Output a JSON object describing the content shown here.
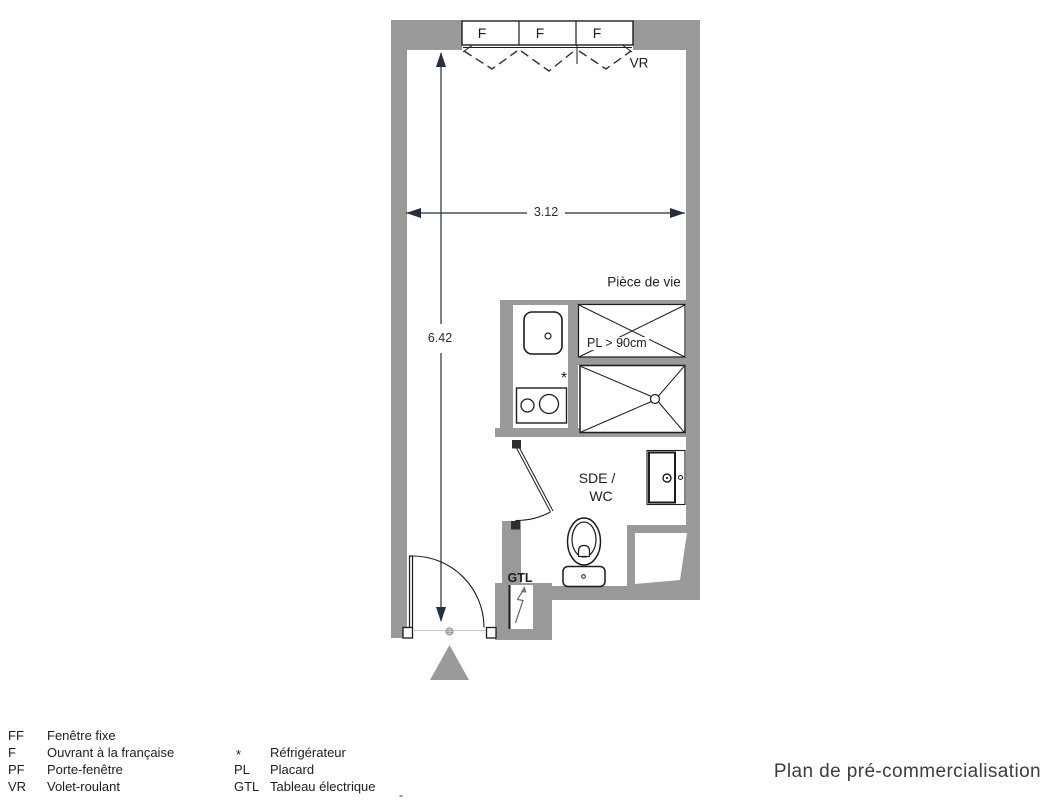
{
  "colors": {
    "wall": "#9a9a9a",
    "line": "#1c1c1c",
    "text": "#1d1d1f",
    "dim": "#232e3f",
    "muted": "#3d3d3d"
  },
  "plan": {
    "window": {
      "panels": [
        "F",
        "F",
        "F"
      ],
      "shutter_label": "VR"
    },
    "dimensions": {
      "width": "3.12",
      "height": "6.42"
    },
    "labels": {
      "living_room": "Pièce de vie",
      "closet": "PL > 90cm",
      "bathroom_line1": "SDE /",
      "bathroom_line2": "WC",
      "electrical_panel": "GTL",
      "fridge_symbol": "*"
    }
  },
  "legend": {
    "column1": [
      {
        "abbr": "FF",
        "label": "Fenêtre fixe"
      },
      {
        "abbr": "F",
        "label": "Ouvrant à la française"
      },
      {
        "abbr": "PF",
        "label": "Porte-fenêtre"
      },
      {
        "abbr": "VR",
        "label": "Volet-roulant"
      }
    ],
    "column2": [
      {
        "abbr": "*",
        "label": "Réfrigérateur"
      },
      {
        "abbr": "PL",
        "label": "Placard"
      },
      {
        "abbr": "GTL",
        "label": "Tableau électrique"
      }
    ],
    "stray_mark": "-"
  },
  "footer": {
    "title": "Plan de pré-commercialisation"
  }
}
